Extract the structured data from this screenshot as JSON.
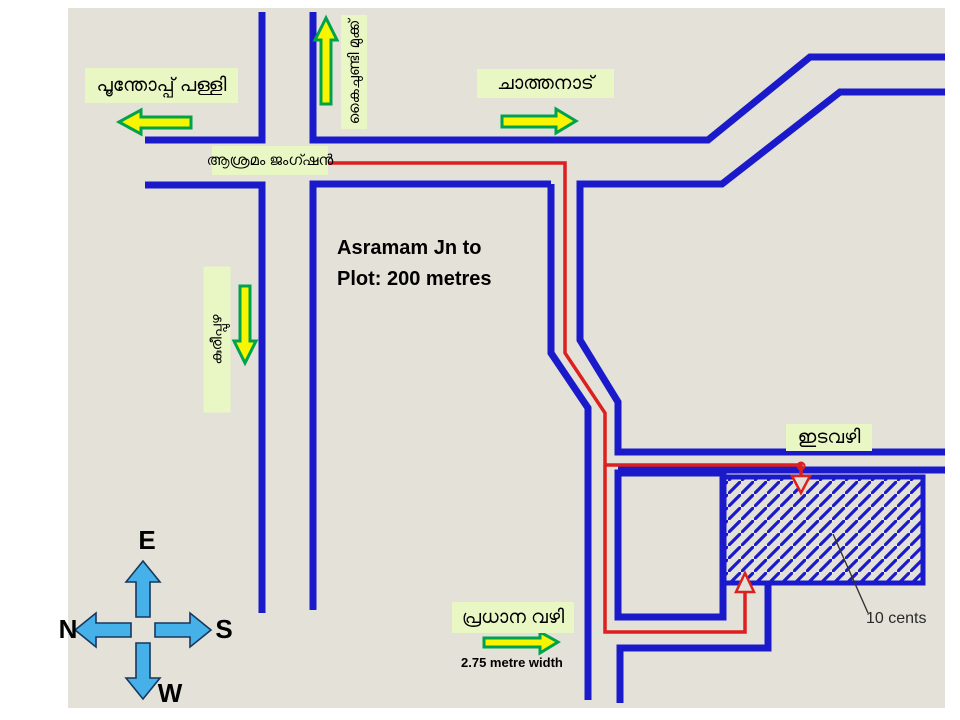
{
  "map": {
    "labels": {
      "west_destination": "പൂന്തോപ്പ് പള്ളി",
      "north_destination": "കൈചുണ്ടി മുക്ക്",
      "east_destination": "ചാത്തനാട്",
      "south_destination": "കുരീപ്പുഴ",
      "junction": "ആശ്രമം ജംഗ്ഷൻ",
      "lane": "ഇടവഴി",
      "main_way": "പ്രധാന വഴി"
    },
    "notes": {
      "distance_line1": "Asramam Jn to",
      "distance_line2": "Plot: 200 metres",
      "main_way_width": "2.75 metre width",
      "plot_area": "10 cents"
    },
    "compass": {
      "top": "E",
      "left": "N",
      "right": "S",
      "bottom": "W"
    },
    "colors": {
      "page_bg": "#ffffff",
      "map_bg": "#e3e1d8",
      "road": "#1a1acb",
      "route": "#dc1f1f",
      "label_bg": "#e9f7c5",
      "arrow_fill": "#f9f500",
      "arrow_stroke": "#00a24c",
      "compass_fill": "#45b1e8",
      "compass_stroke": "#17375e",
      "leader": "#333333",
      "text": "#000000"
    }
  }
}
